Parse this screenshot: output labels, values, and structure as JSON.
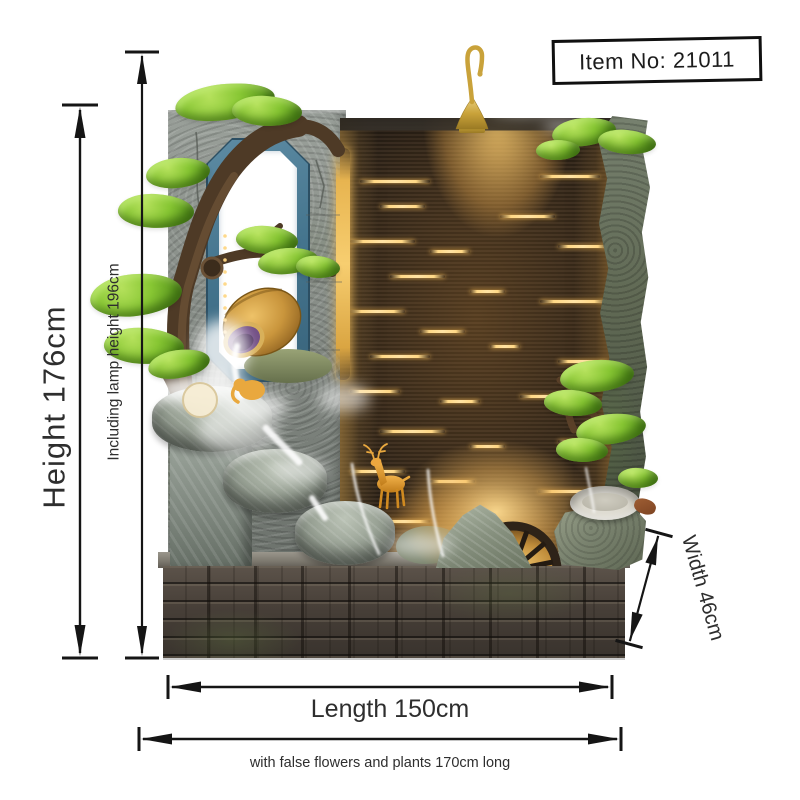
{
  "item_box": {
    "label": "Item No: 21011"
  },
  "dimensions": {
    "height_label": "Height 176cm",
    "lamp_height_label": "Including lamp height 196cm",
    "width_label": "Width 46cm",
    "length_label": "Length 150cm",
    "overall_note": "with false flowers and plants 170cm long"
  },
  "colors": {
    "annotation": "#151515",
    "frame_teal": "#4a7b95",
    "glow_gold": "#f0bc5a",
    "foliage_green": "#7fbf2f",
    "lamp_gold": "#c9a23a"
  },
  "artwork": {
    "streaks": [
      {
        "x": 20,
        "y": 62,
        "w": 70
      },
      {
        "x": 200,
        "y": 57,
        "w": 60
      },
      {
        "x": 40,
        "y": 87,
        "w": 45
      },
      {
        "x": 160,
        "y": 97,
        "w": 55
      },
      {
        "x": 10,
        "y": 122,
        "w": 65
      },
      {
        "x": 90,
        "y": 132,
        "w": 40
      },
      {
        "x": 218,
        "y": 127,
        "w": 50
      },
      {
        "x": 50,
        "y": 157,
        "w": 55
      },
      {
        "x": 130,
        "y": 172,
        "w": 35
      },
      {
        "x": 10,
        "y": 192,
        "w": 55
      },
      {
        "x": 200,
        "y": 182,
        "w": 68
      },
      {
        "x": 80,
        "y": 212,
        "w": 45
      },
      {
        "x": 30,
        "y": 237,
        "w": 60
      },
      {
        "x": 150,
        "y": 227,
        "w": 30
      },
      {
        "x": 218,
        "y": 242,
        "w": 50
      },
      {
        "x": 10,
        "y": 272,
        "w": 50
      },
      {
        "x": 100,
        "y": 282,
        "w": 40
      },
      {
        "x": 180,
        "y": 277,
        "w": 55
      },
      {
        "x": 40,
        "y": 312,
        "w": 65
      },
      {
        "x": 130,
        "y": 327,
        "w": 35
      },
      {
        "x": 218,
        "y": 322,
        "w": 50
      },
      {
        "x": 10,
        "y": 352,
        "w": 55
      },
      {
        "x": 90,
        "y": 362,
        "w": 45
      },
      {
        "x": 198,
        "y": 372,
        "w": 68
      },
      {
        "x": 40,
        "y": 402,
        "w": 50
      },
      {
        "x": 150,
        "y": 412,
        "w": 40
      },
      {
        "x": 218,
        "y": 407,
        "w": 50
      },
      {
        "x": 60,
        "y": 432,
        "w": 45
      }
    ],
    "foliage": [
      {
        "x": 175,
        "y": 84,
        "w": 100,
        "h": 36,
        "rot": -6
      },
      {
        "x": 232,
        "y": 96,
        "w": 70,
        "h": 30,
        "rot": 4
      },
      {
        "x": 146,
        "y": 158,
        "w": 64,
        "h": 30,
        "rot": -4
      },
      {
        "x": 118,
        "y": 194,
        "w": 76,
        "h": 34,
        "rot": 3
      },
      {
        "x": 90,
        "y": 274,
        "w": 92,
        "h": 42,
        "rot": -5
      },
      {
        "x": 104,
        "y": 328,
        "w": 80,
        "h": 36,
        "rot": 4
      },
      {
        "x": 148,
        "y": 350,
        "w": 62,
        "h": 28,
        "rot": -8
      },
      {
        "x": 236,
        "y": 226,
        "w": 62,
        "h": 28,
        "rot": 5
      },
      {
        "x": 258,
        "y": 248,
        "w": 60,
        "h": 26,
        "rot": -4
      },
      {
        "x": 296,
        "y": 256,
        "w": 44,
        "h": 22,
        "rot": 6
      },
      {
        "x": 552,
        "y": 118,
        "w": 64,
        "h": 28,
        "rot": -5
      },
      {
        "x": 598,
        "y": 130,
        "w": 58,
        "h": 24,
        "rot": 6
      },
      {
        "x": 536,
        "y": 140,
        "w": 44,
        "h": 20,
        "rot": 0
      },
      {
        "x": 560,
        "y": 360,
        "w": 74,
        "h": 32,
        "rot": -4
      },
      {
        "x": 544,
        "y": 390,
        "w": 58,
        "h": 26,
        "rot": 5
      },
      {
        "x": 576,
        "y": 414,
        "w": 70,
        "h": 30,
        "rot": -6
      },
      {
        "x": 556,
        "y": 438,
        "w": 52,
        "h": 24,
        "rot": 4
      },
      {
        "x": 618,
        "y": 468,
        "w": 40,
        "h": 20,
        "rot": 3
      }
    ]
  }
}
